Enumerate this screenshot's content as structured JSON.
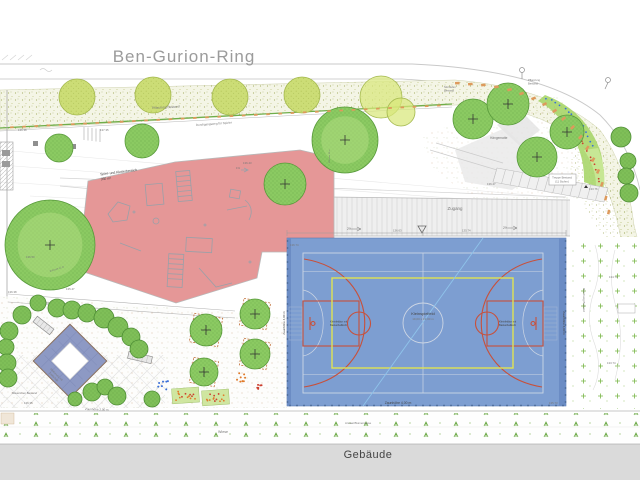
{
  "street": {
    "name": "Ben-Gurion-Ring"
  },
  "building": {
    "label": "Gebäude"
  },
  "site": {
    "pflanzung_1": "Pflanzung Bestand",
    "pflanzung_r1": "Pflanzung",
    "pflanzung_r2": "Bestand",
    "weg_oben": "Durchgangsweg für Spieler",
    "weg_unten": "Durchgangsweg für Spieler",
    "zugang": "Zugang",
    "wiese": "Wiese",
    "ansaat": "Ansaat Blumenwiese",
    "maeuerchen": "Mäuerchen Bestand",
    "haengematte": "Hängematte",
    "sitzstufen_1": "Sitzstufen",
    "sitzstufen_2": "Bestand",
    "treppe_1": "Treppe Bestand",
    "treppe_2": "(11 Stufen)",
    "boeschung": "Böschung Bestand",
    "spielbereich_1": "Spiel- und Kletterbereich",
    "spielbereich_2": "350 m²",
    "zaun2": "Zaunhöhe 2,00 m",
    "krone_l": "Ø Krone 12 m",
    "krone_m": "Ø Krone 12 m",
    "slope_a": "2%",
    "slope_b": "2%",
    "slope_c": "1%"
  },
  "court": {
    "center": "Kleinspielfeld",
    "dim": "19,00 x 13,00 m",
    "goal_left_1": "Kleinfeldtor mit",
    "goal_left_2": "Basketballkorb",
    "goal_right_1": "Kleinfeldtor mit",
    "goal_right_2": "Basketballkorb",
    "fence_bottom": "Zaunhöhe 4,00 m",
    "fence_left": "Zaunhöhe 4,00 m",
    "fence_right": "Zaunhöhe 4,00 m"
  },
  "diamond": {
    "label_1": "Kletternetz mit",
    "label_2": "Fallschutz"
  },
  "elevations": [
    "136.38",
    "137.35",
    "136.43",
    "136.47",
    "133.76",
    "136.50",
    "135.47",
    "136.35",
    "134.74",
    "133.74",
    "136.74",
    "135.73",
    "136.63",
    "135.74",
    "136.38"
  ],
  "colors": {
    "play_area_red": "#E59797",
    "court_blue": "#7D9ED1",
    "court_line_orange": "#C8503A",
    "court_line_yellow": "#E0E353",
    "tree_green": "#8BCA62",
    "light_tree_green": "#CCDD76",
    "diamond_blue": "#8D99C4",
    "building_gray": "#DADADA",
    "curb_orange": "#DD9A5C"
  }
}
